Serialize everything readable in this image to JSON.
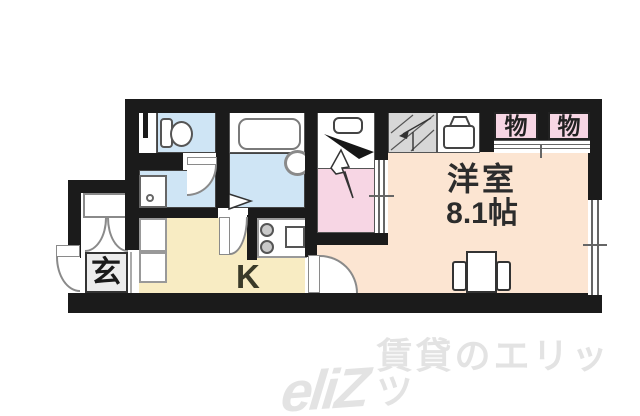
{
  "floorplan": {
    "wall_color": "#1b1b1b",
    "main_room": {
      "name_label": "洋室",
      "size_label": "8.1帖",
      "color": "#fce5d2"
    },
    "kitchen": {
      "label": "K",
      "color": "#f8ecc3"
    },
    "entrance": {
      "label": "玄",
      "color": "#ececec"
    },
    "storage_left": {
      "label": "物",
      "color": "#f7d6e4"
    },
    "storage_right": {
      "label": "物",
      "color": "#f7d6e4"
    },
    "laundry_room": {
      "color": "#f7d6e4"
    },
    "wet_area_color": "#cfe5f5",
    "stairs_color": "#d7d7d7"
  },
  "watermark": {
    "logo": "eliZ",
    "text": "賃貸のエリッツ",
    "color": "#e3e3e3"
  }
}
